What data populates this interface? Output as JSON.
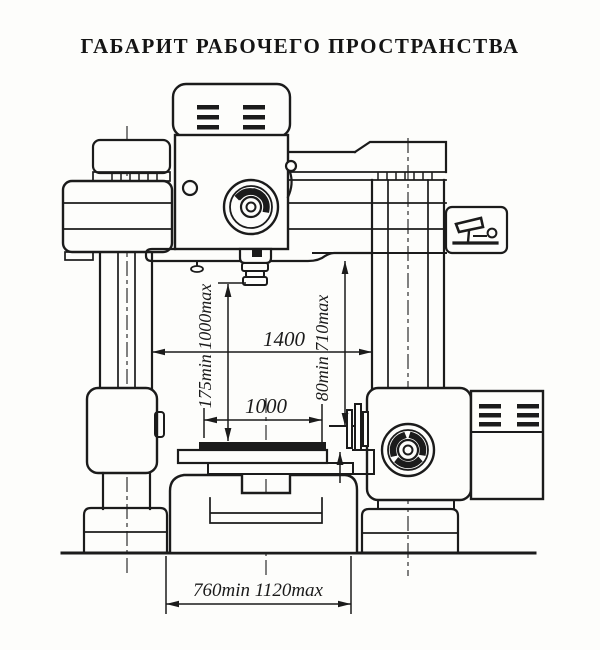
{
  "title": "ГАБАРИТ РАБОЧЕГО ПРОСТРАНСТВА",
  "dimensions": {
    "column_span": "1400",
    "table_length": "1000",
    "spindle_to_table": "175min 1000max",
    "arm_to_table": "80min 710max",
    "base_clearance": "760min 1120max"
  },
  "colors": {
    "ink": "#1b1b1b",
    "paper": "#fdfdfb"
  }
}
